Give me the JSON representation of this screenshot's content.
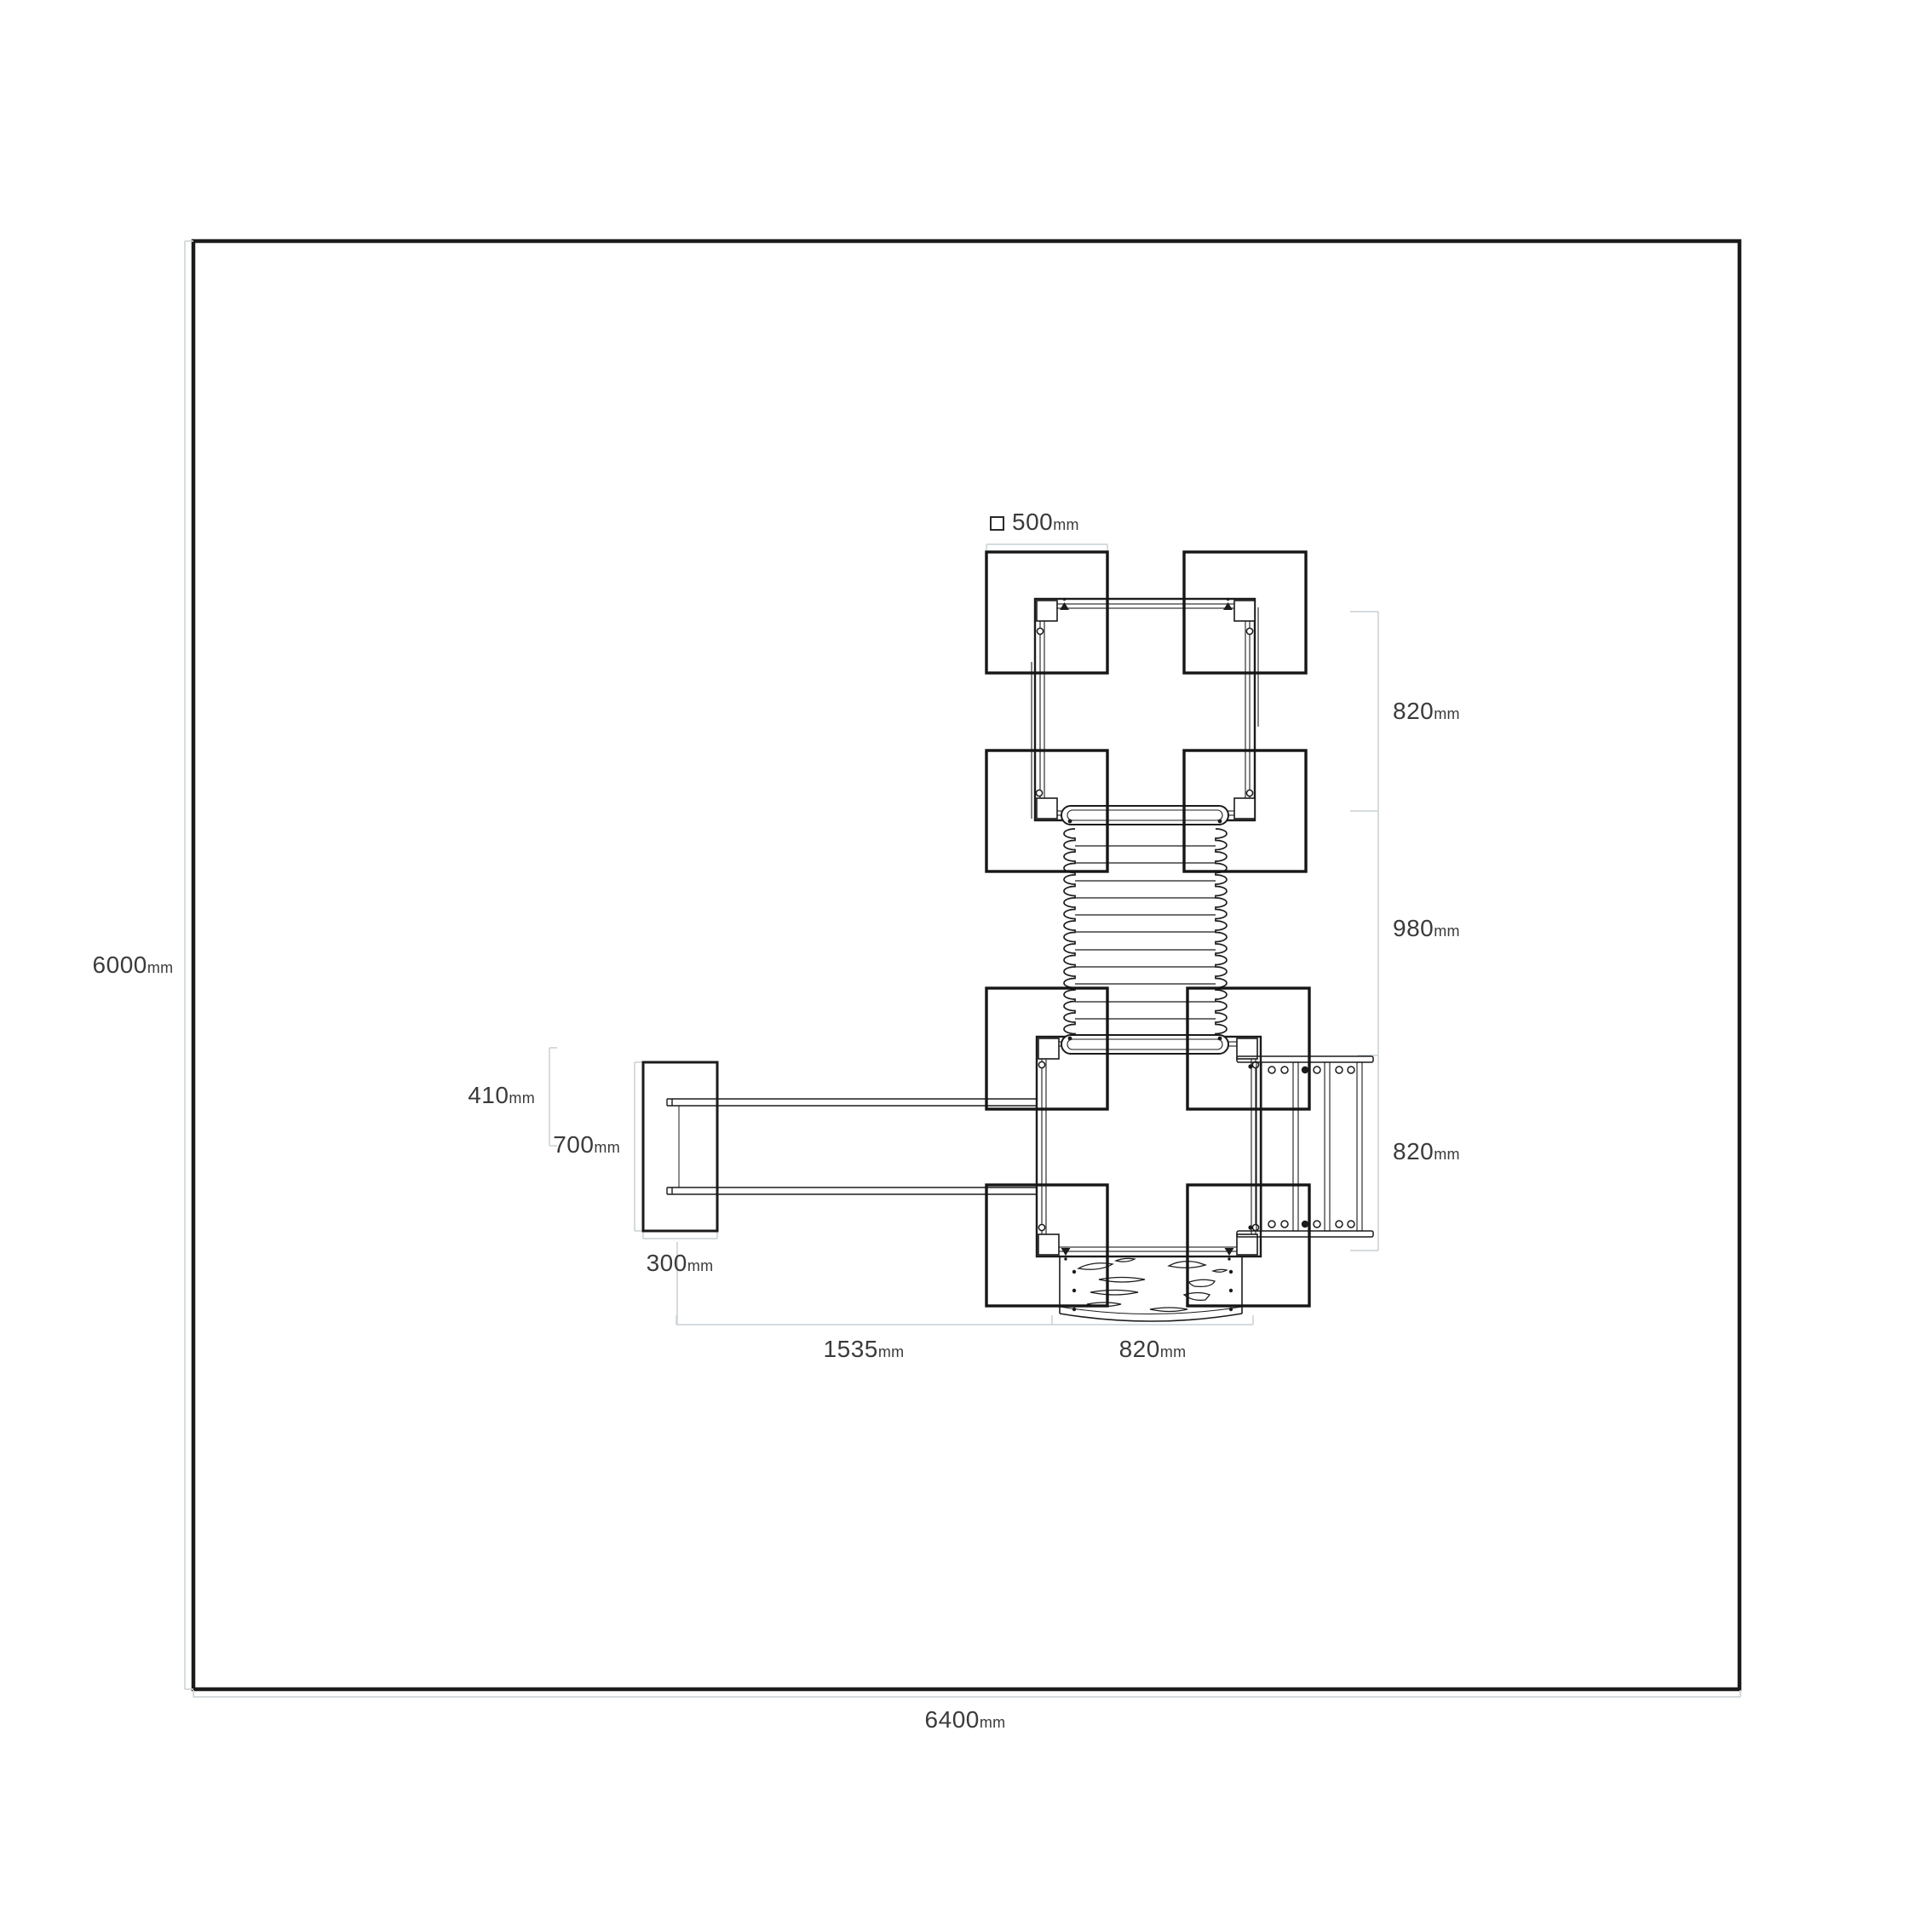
{
  "drawing": {
    "type": "playground-equipment-plan-view",
    "colors": {
      "background": "#ffffff",
      "line": "#1b1b1b",
      "dimension_line": "#cfd6d9",
      "label_text": "#3b3b3b"
    },
    "dimensions": {
      "post_size": {
        "symbol": "square-outline",
        "value": "500",
        "unit": "mm"
      },
      "area_height": {
        "value": "6000",
        "unit": "mm"
      },
      "area_width": {
        "value": "6400",
        "unit": "mm"
      },
      "upper_platform_depth": {
        "value": "820",
        "unit": "mm"
      },
      "tunnel_length": {
        "value": "980",
        "unit": "mm"
      },
      "lower_platform_depth": {
        "value": "820",
        "unit": "mm"
      },
      "beam_offset": {
        "value": "410",
        "unit": "mm"
      },
      "end_block_length": {
        "value": "700",
        "unit": "mm"
      },
      "end_block_width": {
        "value": "300",
        "unit": "mm"
      },
      "beam_span": {
        "value": "1535",
        "unit": "mm"
      },
      "slide_width": {
        "value": "820",
        "unit": "mm"
      }
    }
  }
}
